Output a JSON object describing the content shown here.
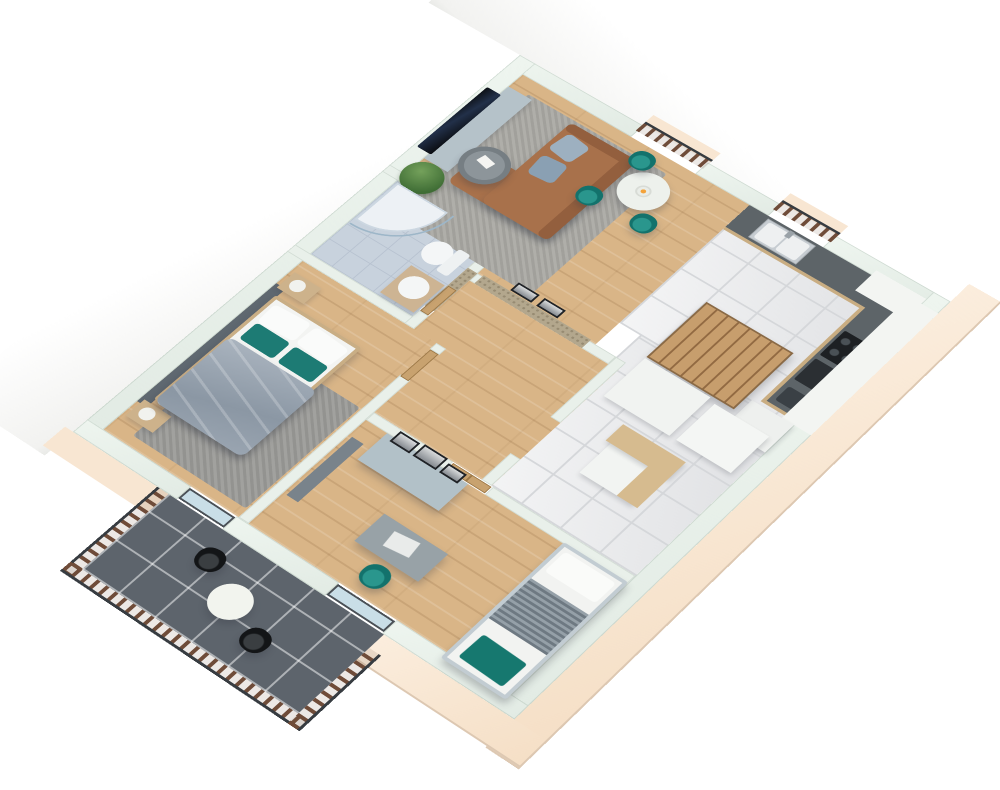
{
  "meta": {
    "description": "3D isometric dollhouse rendering of an apartment floor plan, no text labels",
    "rooms": [
      "living-dining-room",
      "kitchen",
      "corridor-with-stairs",
      "hallway",
      "bathroom",
      "master-bedroom",
      "office-bedroom",
      "balcony"
    ]
  },
  "palette": {
    "background": "#ffffff",
    "wall_top": "#e9f0ea",
    "exterior_band": "#f8e6d2",
    "wood_floor": "#d9b587",
    "marble_floor": "#e6e7e9",
    "bath_tile": "#c8d2dd",
    "balcony_tile": "#5d646c",
    "sofa_brown": "#a8714b",
    "accent_teal": "#177d77",
    "rug_gray": "#a9a8a3",
    "counter_dark": "#5d6468",
    "cabinet_wood": "#c9ad82",
    "railing_wood": "#6f4c39",
    "railing_rail": "#373c41"
  },
  "scene": {
    "elements": [
      {
        "n": "nw-exterior-wall-face",
        "c": "whiteband",
        "x": -120,
        "y": -70,
        "w": 120,
        "h": 760
      },
      {
        "n": "ne-exterior-wall-face",
        "c": "whitebandh",
        "x": -120,
        "y": -120,
        "w": 720,
        "h": 120
      },
      {
        "n": "se-exterior-wall-face",
        "c": "cream",
        "x": 531,
        "y": -30,
        "w": 38,
        "h": 722
      },
      {
        "n": "sw-exterior-wall-face",
        "c": "cream",
        "x": 380,
        "y": 652,
        "w": 189,
        "h": 38
      },
      {
        "n": "sw-exterior-wall-face-west",
        "c": "cream2",
        "x": -10,
        "y": 652,
        "w": 130,
        "h": 30
      },
      {
        "n": "living-room-floor",
        "c": "wood",
        "x": 20,
        "y": 20,
        "w": 285,
        "h": 238
      },
      {
        "n": "kitchen-floor",
        "c": "marble",
        "x": 305,
        "y": 20,
        "w": 206,
        "h": 202
      },
      {
        "n": "corridor-floor",
        "c": "marble",
        "x": 330,
        "y": 222,
        "w": 181,
        "h": 234
      },
      {
        "n": "hallway-floor",
        "c": "wood",
        "x": 160,
        "y": 270,
        "w": 182,
        "h": 186
      },
      {
        "n": "bathroom-floor",
        "c": "bathtile",
        "x": 20,
        "y": 212,
        "w": 128,
        "h": 128
      },
      {
        "n": "bedroom-floor",
        "c": "wood",
        "x": 20,
        "y": 352,
        "w": 168,
        "h": 280
      },
      {
        "n": "office-floor",
        "c": "wood",
        "x": 200,
        "y": 468,
        "w": 311,
        "h": 164
      },
      {
        "n": "balcony-floor",
        "c": "balctile",
        "x": 120,
        "y": 652,
        "w": 260,
        "h": 116
      },
      {
        "n": "wall-north-a",
        "c": "mintx",
        "x": 0,
        "y": 0,
        "w": 158,
        "h": 20
      },
      {
        "n": "wall-north-b",
        "c": "mintx",
        "x": 238,
        "y": 0,
        "w": 90,
        "h": 20
      },
      {
        "n": "wall-north-c",
        "c": "mintx",
        "x": 394,
        "y": 0,
        "w": 137,
        "h": 20
      },
      {
        "n": "wall-west",
        "c": "mintx",
        "x": 0,
        "y": 0,
        "w": 20,
        "h": 652
      },
      {
        "n": "wall-east",
        "c": "mintx",
        "x": 511,
        "y": 0,
        "w": 20,
        "h": 652
      },
      {
        "n": "wall-south-a",
        "c": "mintx",
        "x": 0,
        "y": 632,
        "w": 130,
        "h": 20
      },
      {
        "n": "wall-south-b",
        "c": "mintx",
        "x": 186,
        "y": 632,
        "w": 124,
        "h": 20
      },
      {
        "n": "wall-south-c",
        "c": "mintx",
        "x": 378,
        "y": 632,
        "w": 153,
        "h": 20
      },
      {
        "n": "wall-bathroom-north",
        "c": "mint",
        "x": 0,
        "y": 200,
        "w": 160,
        "h": 12
      },
      {
        "n": "wall-bathroom-south",
        "c": "mint",
        "x": 0,
        "y": 340,
        "w": 160,
        "h": 12
      },
      {
        "n": "wall-bathroom-east-upper",
        "c": "mint",
        "x": 148,
        "y": 200,
        "w": 12,
        "h": 88
      },
      {
        "n": "wall-bathroom-east-lower",
        "c": "mint",
        "x": 148,
        "y": 330,
        "w": 12,
        "h": 22
      },
      {
        "n": "wall-living-south",
        "c": "mint",
        "x": 160,
        "y": 258,
        "w": 170,
        "h": 12
      },
      {
        "n": "mosaic-accent-wall",
        "c": "mosaic",
        "x": 166,
        "y": 256,
        "w": 132,
        "h": 14
      },
      {
        "n": "mosaic-accent-wall-corner",
        "c": "mosaic",
        "x": 148,
        "y": 258,
        "w": 12,
        "h": 64
      },
      {
        "n": "wall-hall-east-upper",
        "c": "mint",
        "x": 330,
        "y": 258,
        "w": 12,
        "h": 98
      },
      {
        "n": "wall-hall-east-lower",
        "c": "mint",
        "x": 330,
        "y": 414,
        "w": 12,
        "h": 42
      },
      {
        "n": "wall-bedroom-east-stub",
        "c": "mint",
        "x": 188,
        "y": 352,
        "w": 12,
        "h": 10
      },
      {
        "n": "wall-bedroom-east",
        "c": "mint",
        "x": 188,
        "y": 404,
        "w": 12,
        "h": 228
      },
      {
        "n": "wall-office-north-a",
        "c": "mint",
        "x": 200,
        "y": 456,
        "w": 96,
        "h": 12
      },
      {
        "n": "wall-office-north-b",
        "c": "mint",
        "x": 344,
        "y": 456,
        "w": 167,
        "h": 12
      },
      {
        "n": "bathroom-door",
        "c": "doorw",
        "x": 149,
        "y": 288,
        "w": 10,
        "h": 42
      },
      {
        "n": "bedroom-door",
        "c": "doorw",
        "x": 189,
        "y": 362,
        "w": 10,
        "h": 44
      },
      {
        "n": "office-double-door",
        "c": "doorw doors2",
        "x": 297,
        "y": 457,
        "w": 46,
        "h": 10
      },
      {
        "n": "juliet-balcony-ledge",
        "c": "cream2",
        "x": 156,
        "y": -18,
        "w": 84,
        "h": 16
      },
      {
        "n": "juliet-balcony-railing",
        "c": "railx railtop",
        "x": 156,
        "y": -6,
        "w": 84,
        "h": 16
      },
      {
        "n": "kitchen-window-ledge",
        "c": "cream2",
        "x": 326,
        "y": -18,
        "w": 70,
        "h": 16
      },
      {
        "n": "kitchen-window-railing",
        "c": "railx railtop",
        "x": 326,
        "y": -6,
        "w": 70,
        "h": 16
      },
      {
        "n": "living-rug",
        "c": "rug",
        "x": 42,
        "y": 38,
        "w": 175,
        "h": 210
      },
      {
        "n": "bedroom-rug",
        "c": "rug2",
        "x": 46,
        "y": 460,
        "w": 140,
        "h": 160
      },
      {
        "n": "tv-cabinet",
        "c": "soft seamsy",
        "x": 20,
        "y": 42,
        "w": 30,
        "h": 130,
        "bg": "#b5c2c9"
      },
      {
        "n": "tv",
        "c": "tv",
        "x": 4,
        "y": 56,
        "w": 18,
        "h": 108
      },
      {
        "n": "plant-pot",
        "x": 28,
        "y": 186,
        "w": 18,
        "h": 16,
        "bg": "#9aa4a8"
      },
      {
        "n": "plant",
        "c": "plant",
        "x": 14,
        "y": 172,
        "w": 44,
        "h": 44
      },
      {
        "n": "sofa-chaise",
        "c": "shadowed",
        "x": 58,
        "y": 128,
        "w": 126,
        "h": 54,
        "bg": "#a8714b",
        "r": 8
      },
      {
        "n": "sofa-body",
        "c": "shadowed",
        "x": 100,
        "y": 42,
        "w": 84,
        "h": 140,
        "bg": "#a8714b",
        "r": 8
      },
      {
        "n": "sofa-backrest",
        "x": 170,
        "y": 42,
        "w": 14,
        "h": 140,
        "bg": "#935f3e",
        "r": 6
      },
      {
        "n": "sofa-armrest",
        "x": 100,
        "y": 42,
        "w": 84,
        "h": 12,
        "bg": "#935f3e",
        "r": 6
      },
      {
        "n": "sofa-cushion-a",
        "x": 106,
        "y": 56,
        "w": 30,
        "h": 30,
        "bg": "#9db0c0",
        "r": 6,
        "rot": 8
      },
      {
        "n": "sofa-cushion-b",
        "x": 108,
        "y": 92,
        "w": 30,
        "h": 30,
        "bg": "#8aa0b3",
        "r": 6,
        "rot": -6
      },
      {
        "n": "coffee-table",
        "c": "shadowed",
        "x": 46,
        "y": 116,
        "w": 52,
        "h": 52,
        "bg": "#767e83",
        "r": "50%"
      },
      {
        "n": "coffee-table-top",
        "x": 52,
        "y": 122,
        "w": 40,
        "h": 40,
        "bg": "#8d959a",
        "r": "50%"
      },
      {
        "n": "coffee-table-papers",
        "x": 62,
        "y": 132,
        "w": 16,
        "h": 11,
        "bg": "#f5f5f2",
        "rot": 12
      },
      {
        "n": "dining-table",
        "c": "shadowed",
        "x": 188,
        "y": 45,
        "w": 52,
        "h": 52,
        "bg": "#edf1ec",
        "r": "50%"
      },
      {
        "n": "fruit-bowl",
        "c": "bowl",
        "x": 206,
        "y": 63,
        "w": 16,
        "h": 16
      },
      {
        "n": "dining-chair-a",
        "c": "tealchair shadowed",
        "x": 174,
        "y": 26,
        "w": 26,
        "h": 26,
        "r": "45%"
      },
      {
        "n": "dining-chair-b",
        "c": "tealchair shadowed",
        "x": 164,
        "y": 96,
        "w": 26,
        "h": 26,
        "r": "45%"
      },
      {
        "n": "dining-chair-c",
        "c": "tealchair shadowed",
        "x": 228,
        "y": 92,
        "w": 26,
        "h": 26,
        "r": "45%"
      },
      {
        "n": "art-frame-a",
        "c": "frame",
        "x": 198,
        "y": 242,
        "w": 26,
        "h": 13
      },
      {
        "n": "art-frame-b",
        "c": "frame",
        "x": 230,
        "y": 242,
        "w": 26,
        "h": 13
      },
      {
        "n": "kitchen-counter-base",
        "x": 305,
        "y": 20,
        "w": 206,
        "h": 42,
        "bg": "#c9ad82"
      },
      {
        "n": "kitchen-counter-top",
        "x": 305,
        "y": 20,
        "w": 206,
        "h": 38,
        "bg": "#5d6468"
      },
      {
        "n": "kitchen-sink-unit",
        "c": "steel",
        "x": 330,
        "y": 23,
        "w": 58,
        "h": 32
      },
      {
        "n": "kitchen-sink-basin-a",
        "x": 334,
        "y": 26,
        "w": 24,
        "h": 26,
        "bg": "#eef0f1",
        "r": 3
      },
      {
        "n": "kitchen-sink-basin-b",
        "x": 360,
        "y": 26,
        "w": 24,
        "h": 26,
        "bg": "#eef0f1",
        "r": 3
      },
      {
        "n": "kitchen-faucet",
        "x": 356,
        "y": 22,
        "w": 6,
        "h": 10,
        "bg": "#9aa2a8"
      },
      {
        "n": "kitchen-counter-base-2",
        "x": 469,
        "y": 58,
        "w": 42,
        "h": 158,
        "bg": "#c9ad82"
      },
      {
        "n": "kitchen-counter-top-2",
        "x": 473,
        "y": 58,
        "w": 38,
        "h": 154,
        "bg": "#5d6468"
      },
      {
        "n": "cooktop",
        "c": "hob",
        "x": 476,
        "y": 94,
        "w": 32,
        "h": 40,
        "r": 2
      },
      {
        "n": "oven",
        "x": 476,
        "y": 140,
        "w": 32,
        "h": 34,
        "bg": "#2b2f33",
        "r": 2
      },
      {
        "n": "coffee-machine",
        "x": 478,
        "y": 184,
        "w": 26,
        "h": 22,
        "bg": "#3a4045",
        "r": 3
      },
      {
        "n": "upper-cabinets",
        "c": "seamsy",
        "x": 497,
        "y": 20,
        "w": 34,
        "h": 200,
        "bg": "#f3f5f2"
      },
      {
        "n": "corner-upper-cabinet",
        "x": 452,
        "y": 12,
        "w": 59,
        "h": 34,
        "bg": "#f3f5f2"
      },
      {
        "n": "kitchen-tall-cabinet",
        "c": "soft",
        "x": 462,
        "y": 220,
        "w": 49,
        "h": 44,
        "bg": "#eef0ee"
      },
      {
        "n": "staircase",
        "c": "stairs shadowed",
        "x": 352,
        "y": 148,
        "w": 104,
        "h": 92
      },
      {
        "n": "stair-landing-block",
        "c": "soft",
        "x": 352,
        "y": 242,
        "w": 78,
        "h": 62,
        "bg": "#f1f3f1"
      },
      {
        "n": "stair-side-block",
        "c": "soft",
        "x": 438,
        "y": 246,
        "w": 64,
        "h": 58,
        "bg": "#f4f6f4"
      },
      {
        "n": "understair-cabinet",
        "c": "soft",
        "x": 394,
        "y": 332,
        "w": 62,
        "h": 60,
        "bg": "#f2f4f2"
      },
      {
        "n": "understair-counter",
        "c": "soft",
        "x": 388,
        "y": 320,
        "w": 74,
        "h": 26,
        "bg": "#d6bb8f"
      },
      {
        "n": "understair-counter-side",
        "x": 438,
        "y": 320,
        "w": 24,
        "h": 72,
        "bg": "#d6bb8f"
      },
      {
        "n": "shower-tray",
        "c": "shower",
        "x": 22,
        "y": 214,
        "w": 64,
        "h": 64
      },
      {
        "n": "shower-glass",
        "c": "showerglass",
        "x": 22,
        "y": 214,
        "w": 72,
        "h": 72
      },
      {
        "n": "toilet-bowl",
        "x": 98,
        "y": 246,
        "w": 30,
        "h": 32,
        "bg": "#f4f6f7",
        "r": "50%"
      },
      {
        "n": "toilet-tank",
        "x": 126,
        "y": 244,
        "w": 14,
        "h": 36,
        "bg": "#eef1f2",
        "r": 3
      },
      {
        "n": "bathroom-vanity",
        "c": "soft",
        "x": 104,
        "y": 290,
        "w": 42,
        "h": 46,
        "bg": "#cdb493"
      },
      {
        "n": "bathroom-round-sink",
        "x": 110,
        "y": 296,
        "w": 30,
        "h": 30,
        "bg": "#f4f6f6",
        "r": "50%"
      },
      {
        "n": "headboard-panel",
        "x": 20,
        "y": 390,
        "w": 12,
        "h": 196,
        "bg": "#5f6870"
      },
      {
        "n": "nightstand-a",
        "c": "soft",
        "x": 24,
        "y": 368,
        "w": 34,
        "h": 26,
        "bg": "#cdb28b"
      },
      {
        "n": "lamp-a",
        "x": 30,
        "y": 372,
        "w": 16,
        "h": 16,
        "bg": "#f1f2ee",
        "r": "50%"
      },
      {
        "n": "nightstand-b",
        "c": "soft",
        "x": 24,
        "y": 580,
        "w": 34,
        "h": 26,
        "bg": "#cdb28b"
      },
      {
        "n": "lamp-b",
        "x": 30,
        "y": 584,
        "w": 16,
        "h": 16,
        "bg": "#f1f2ee",
        "r": "50%"
      },
      {
        "n": "bed-frame",
        "c": "shadowed",
        "x": 30,
        "y": 402,
        "w": 108,
        "h": 172,
        "bg": "#c9ae85",
        "r": 3
      },
      {
        "n": "bed-mattress",
        "x": 34,
        "y": 406,
        "w": 100,
        "h": 164,
        "bg": "#f3f4f2"
      },
      {
        "n": "bed-pillow-a",
        "x": 38,
        "y": 410,
        "w": 44,
        "h": 28,
        "bg": "#fafbfa",
        "r": 5,
        "rot": -4
      },
      {
        "n": "bed-pillow-b",
        "x": 86,
        "y": 410,
        "w": 44,
        "h": 28,
        "bg": "#fafbfa",
        "r": 5,
        "rot": 4
      },
      {
        "n": "bed-teal-pillow-a",
        "x": 40,
        "y": 440,
        "w": 42,
        "h": 26,
        "bg": "#1d7b74",
        "r": 4
      },
      {
        "n": "bed-teal-pillow-b",
        "x": 88,
        "y": 440,
        "w": 42,
        "h": 26,
        "bg": "#1d7b74",
        "r": 4
      },
      {
        "n": "bed-duvet",
        "c": "duvet shadowed",
        "x": 32,
        "y": 470,
        "w": 110,
        "h": 106
      },
      {
        "n": "office-divider-panel",
        "x": 204,
        "y": 492,
        "w": 14,
        "h": 92,
        "bg": "#79838b"
      },
      {
        "n": "wardrobe",
        "c": "seamsx shadowed",
        "x": 226,
        "y": 468,
        "w": 98,
        "h": 42,
        "bg": "#b2c1c8"
      },
      {
        "n": "wardrobe-frame-a",
        "c": "frame",
        "x": 234,
        "y": 458,
        "w": 24,
        "h": 16
      },
      {
        "n": "wardrobe-frame-b",
        "c": "frame",
        "x": 262,
        "y": 456,
        "w": 28,
        "h": 18
      },
      {
        "n": "wardrobe-frame-c",
        "c": "frame",
        "x": 294,
        "y": 460,
        "w": 22,
        "h": 14
      },
      {
        "n": "desk",
        "c": "shadowed",
        "x": 288,
        "y": 544,
        "w": 76,
        "h": 42,
        "bg": "#98a2a7"
      },
      {
        "n": "laptop",
        "x": 310,
        "y": 552,
        "w": 28,
        "h": 20,
        "bg": "#e9ebea",
        "rot": -8
      },
      {
        "n": "desk-chair",
        "c": "tealchair shadowed",
        "x": 316,
        "y": 592,
        "w": 28,
        "h": 28,
        "r": "45%"
      },
      {
        "n": "bed2-frame",
        "c": "shadowed",
        "x": 436,
        "y": 466,
        "w": 75,
        "h": 174,
        "bg": "#c2ccd2",
        "r": 3
      },
      {
        "n": "bed2-mattress",
        "x": 440,
        "y": 470,
        "w": 67,
        "h": 166,
        "bg": "#f2f3f1"
      },
      {
        "n": "bed2-pillow",
        "x": 444,
        "y": 474,
        "w": 59,
        "h": 30,
        "bg": "#fafbf9",
        "r": 4
      },
      {
        "n": "bed2-striped-blanket",
        "c": "stripes",
        "x": 440,
        "y": 518,
        "w": 67,
        "h": 60
      },
      {
        "n": "bed2-teal-throw",
        "x": 448,
        "y": 596,
        "w": 52,
        "h": 34,
        "bg": "#16786f",
        "r": 3,
        "rot": 2
      },
      {
        "n": "bedroom-balcony-door",
        "c": "glass",
        "x": 130,
        "y": 634,
        "w": 56,
        "h": 16
      },
      {
        "n": "office-balcony-door",
        "c": "glass",
        "x": 310,
        "y": 634,
        "w": 68,
        "h": 16
      },
      {
        "n": "balcony-railing-west",
        "c": "raily raill",
        "x": 106,
        "y": 652,
        "w": 14,
        "h": 130
      },
      {
        "n": "balcony-railing-south",
        "c": "railx railbot",
        "x": 106,
        "y": 768,
        "w": 288,
        "h": 14
      },
      {
        "n": "balcony-railing-east",
        "c": "raily railr",
        "x": 380,
        "y": 672,
        "w": 14,
        "h": 110
      },
      {
        "n": "balcony-table",
        "c": "shadowed",
        "x": 228,
        "y": 690,
        "w": 42,
        "h": 42,
        "bg": "#f2f4ee",
        "r": "50%"
      },
      {
        "n": "balcony-chair-a",
        "c": "blackchair shadowed",
        "x": 188,
        "y": 672,
        "w": 28,
        "h": 28,
        "r": "45%",
        "rot": -8
      },
      {
        "n": "balcony-chair-b",
        "c": "blackchair shadowed",
        "x": 282,
        "y": 716,
        "w": 28,
        "h": 28,
        "r": "45%",
        "rot": 6
      }
    ]
  }
}
